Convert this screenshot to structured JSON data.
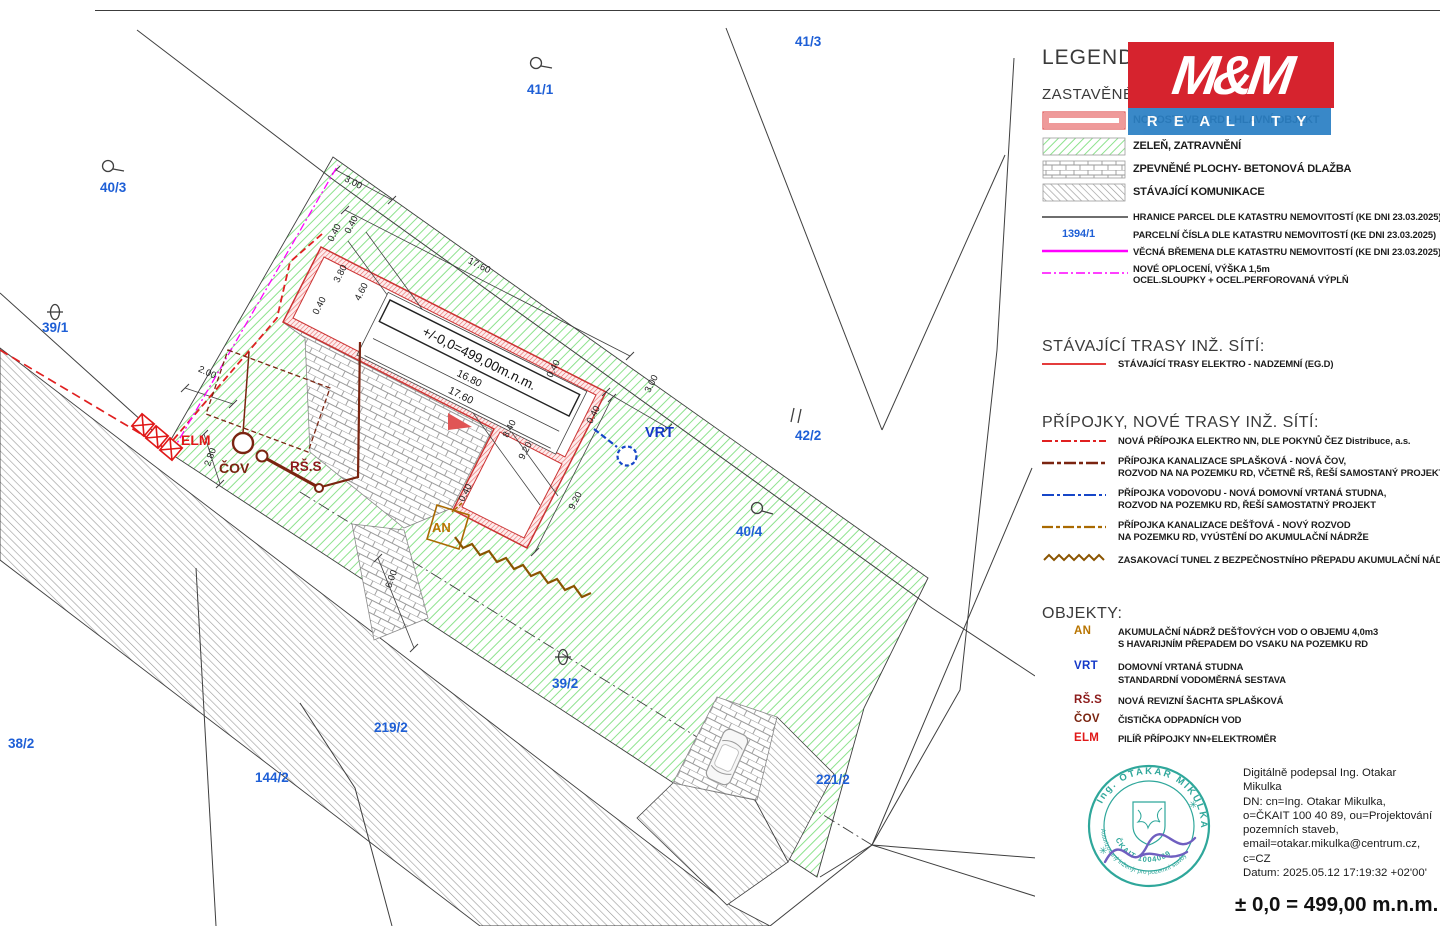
{
  "colors": {
    "parcel_blue": "#1e5fd6",
    "boundary_black": "#3f3f3f",
    "magenta": "#ff00ff",
    "red_electro": "#e02020",
    "brown_sewage": "#7a2410",
    "blue_water": "#1646c8",
    "orange_rain": "#a96a00",
    "zigzag_brown": "#8a5400",
    "green_hatch": "#8de28d",
    "wall_red": "#e05555",
    "stamp_teal": "#2fa79b",
    "signature_purple": "#6f5fc0"
  },
  "legend": {
    "title": "LEGENDA:",
    "subtitle": "ZASTAVĚNÉ PLOCHY:",
    "logo_top": "M&M",
    "logo_bottom": "R E A L I T Y",
    "area_items": [
      {
        "label": "NOVOSTAVBA RD - HLAVNÍ OBJEKT"
      },
      {
        "label": "ZELEŇ, ZATRAVNĚNÍ"
      },
      {
        "label": "ZPEVNĚNÉ PLOCHY- BETONOVÁ DLAŽBA"
      },
      {
        "label": "STÁVAJÍCÍ KOMUNIKACE"
      }
    ],
    "line_items": [
      {
        "label": "HRANICE PARCEL DLE KATASTRU NEMOVITOSTÍ (KE DNI 23.03.2025)"
      },
      {
        "sample": "1394/1",
        "label": "PARCELNÍ ČÍSLA DLE KATASTRU NEMOVITOSTÍ (KE DNI 23.03.2025)"
      },
      {
        "label": "VĚCNÁ BŘEMENA DLE KATASTRU NEMOVITOSTÍ (KE DNI 23.03.2025)"
      },
      {
        "line1": "NOVÉ OPLOCENÍ, VÝŠKA 1,5m",
        "line2": "OCEL.SLOUPKY + OCEL.PERFOROVANÁ VÝPLŇ"
      }
    ],
    "existing_header": "STÁVAJÍCÍ TRASY INŽ. SÍTÍ:",
    "existing_item": "STÁVAJÍCÍ TRASY ELEKTRO - NADZEMNÍ (EG.D)",
    "new_header": "PŘÍPOJKY, NOVÉ TRASY INŽ. SÍTÍ:",
    "new_items": [
      {
        "line1": "NOVÁ PŘÍPOJKA ELEKTRO NN, DLE POKYNŮ ČEZ Distribuce, a.s.",
        "line2": ""
      },
      {
        "line1": "PŘÍPOJKA KANALIZACE SPLAŠKOVÁ - NOVÁ ČOV,",
        "line2": "ROZVOD NA NA POZEMKU RD, VČETNĚ RŠ, ŘEŠÍ SAMOSTANÝ PROJEKT"
      },
      {
        "line1": "PŘÍPOJKA VODOVODU - NOVÁ DOMOVNÍ VRTANÁ STUDNA,",
        "line2": "ROZVOD NA POZEMKU RD, ŘEŠÍ SAMOSTATNÝ PROJEKT"
      },
      {
        "line1": "PŘÍPOJKA KANALIZACE DEŠŤOVÁ - NOVÝ ROZVOD",
        "line2": "NA POZEMKU RD, VYÚSTĚNÍ DO AKUMULAČNÍ NÁDRŽE"
      },
      {
        "line1": "ZASAKOVACÍ TUNEL Z BEZPEČNOSTNÍHO PŘEPADU AKUMULAČNÍ NÁDRŽE",
        "line2": ""
      }
    ],
    "objects_header": "OBJEKTY:",
    "object_items": [
      {
        "abbr": "AN",
        "line1": "AKUMULAČNÍ NÁDRŽ DEŠŤOVÝCH VOD O OBJEMU 4,0m3",
        "line2": "S HAVARIJNÍM PŘEPADEM DO VSAKU NA POZEMKU RD"
      },
      {
        "abbr": "VRT",
        "line1": "DOMOVNÍ VRTANÁ STUDNA",
        "line2": "STANDARDNÍ VODOMĚRNÁ SESTAVA"
      },
      {
        "abbr": "RŠ.S",
        "line1": "NOVÁ REVIZNÍ ŠACHTA SPLAŠKOVÁ",
        "line2": ""
      },
      {
        "abbr": "ČOV",
        "line1": "ČISTIČKA ODPADNÍCH VOD",
        "line2": ""
      },
      {
        "abbr": "ELM",
        "line1": "PILÍŘ PŘÍPOJKY NN+ELEKTROMĚR",
        "line2": ""
      }
    ]
  },
  "plan": {
    "parcels": [
      "41/3",
      "41/1",
      "40/3",
      "39/1",
      "38/2",
      "144/2",
      "219/2",
      "39/2",
      "40/4",
      "42/2",
      "221/2"
    ],
    "object_labels": {
      "elm": "ELM",
      "cov": "ČOV",
      "rss": "RŠ.S",
      "an": "AN",
      "vrt": "VRT"
    },
    "elevation_note": "+/-0,0=499,00m.n.m.",
    "dims": [
      "3.00",
      "17.60",
      "0.40",
      "0.40",
      "3.80",
      "4.60",
      "0.40",
      "16.80",
      "17.60",
      "0.40",
      "3.00",
      "0.40",
      "8.40",
      "9.20",
      "9.20",
      "0.40",
      "2.00",
      "2.80",
      "6.00"
    ]
  },
  "signature": {
    "stamp_arc_top": "Ing. OTAKAR MIKULKA",
    "stamp_arc_bottom": "Autorizovaný inženýr pro pozemní stavby",
    "stamp_number": "ČKAIT 1004089",
    "lines": [
      "Digitálně podepsal Ing. Otakar",
      "Mikulka",
      "DN: cn=Ing. Otakar Mikulka,",
      "o=ČKAIT 100 40 89, ou=Projektování",
      "pozemních staveb,",
      "email=otakar.mikulka@centrum.cz,",
      "c=CZ",
      "Datum: 2025.05.12 17:19:32 +02'00'"
    ],
    "elevation": "± 0,0 = 499,00 m.n.m."
  }
}
